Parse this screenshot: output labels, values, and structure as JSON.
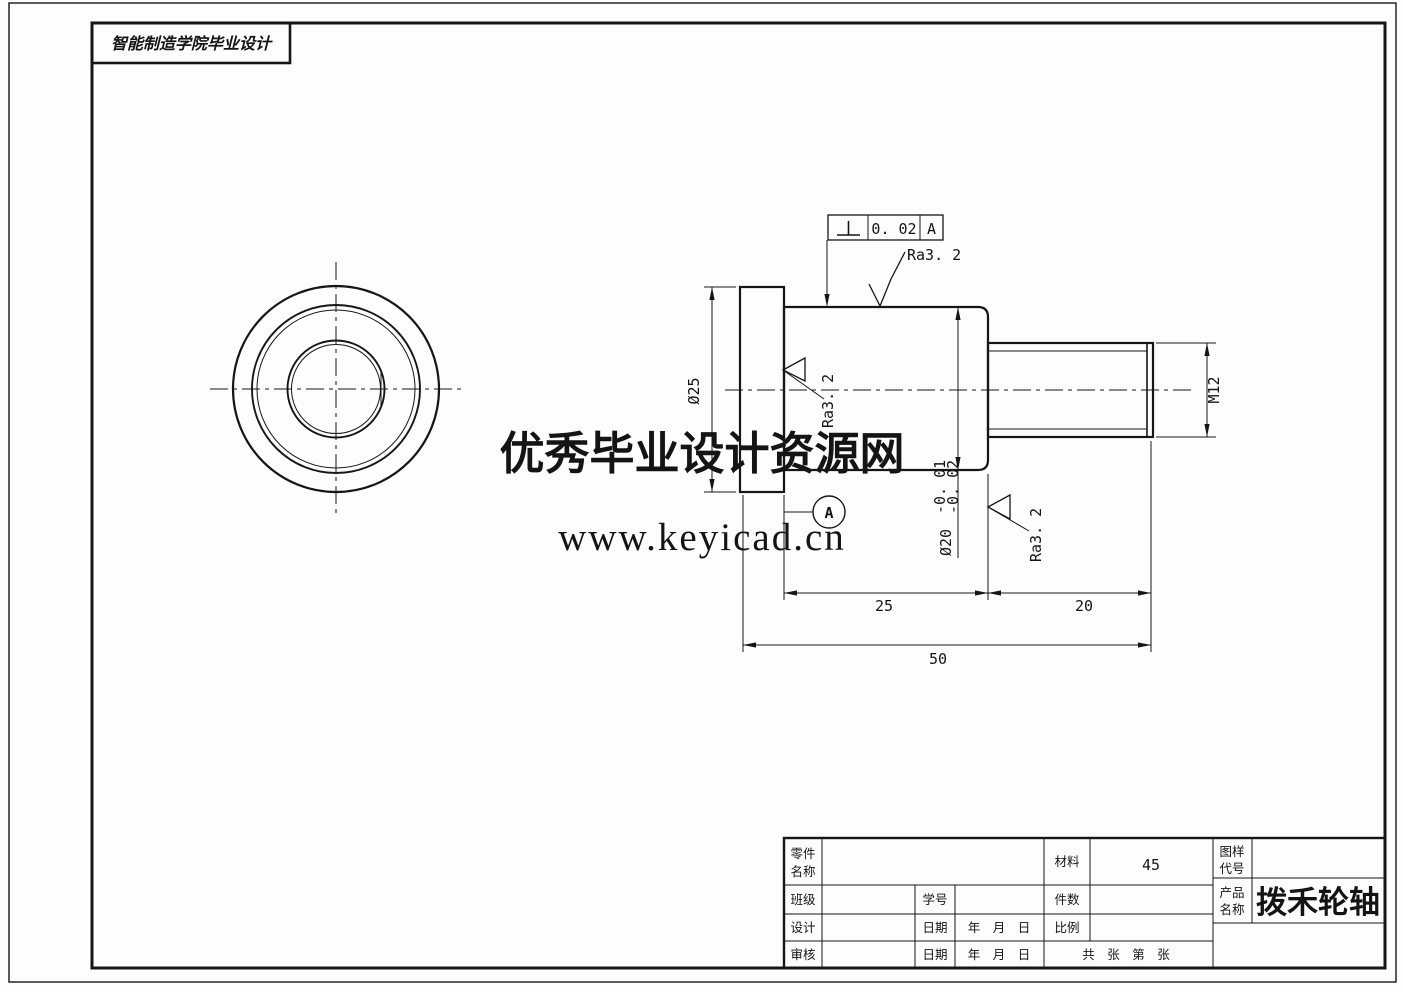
{
  "frame": {
    "school_title": "智能制造学院毕业设计"
  },
  "watermark": {
    "line1": "优秀毕业设计资源网",
    "line2": "www.keyicad.cn",
    "color": "#dc2626"
  },
  "annotations": {
    "tolerance": {
      "symbol_name": "perpendicularity",
      "value": "0. 02",
      "datum": "A"
    },
    "roughness_top": "Ra3. 2",
    "roughness_left": "Ra3. 2",
    "roughness_right": "Ra3. 2",
    "datum_label": "A"
  },
  "dimensions": {
    "flange_diameter": "Ø25",
    "shaft_diameter": "Ø20",
    "shaft_tol_upper": "-0. 01",
    "shaft_tol_lower": "-0. 02",
    "thread_spec": "M12",
    "shaft_length": "25",
    "thread_length": "20",
    "total_length": "50"
  },
  "title_block": {
    "part_name_label": [
      "零件",
      "名称"
    ],
    "class_label": "班级",
    "design_label": "设计",
    "review_label": "审核",
    "student_id_label": "学号",
    "date_label_1": "日期",
    "date_label_2": "日期",
    "date_value_1": "年　月　日",
    "date_value_2": "年　月　日",
    "material_label": "材料",
    "material_value": "45",
    "quantity_label": "件数",
    "scale_label": "比例",
    "sheets_label": "共　张　第　张",
    "drawing_code_label": [
      "图样",
      "代号"
    ],
    "product_name_label": [
      "产品",
      "名称"
    ],
    "product_name_value": "拨禾轮轴"
  }
}
